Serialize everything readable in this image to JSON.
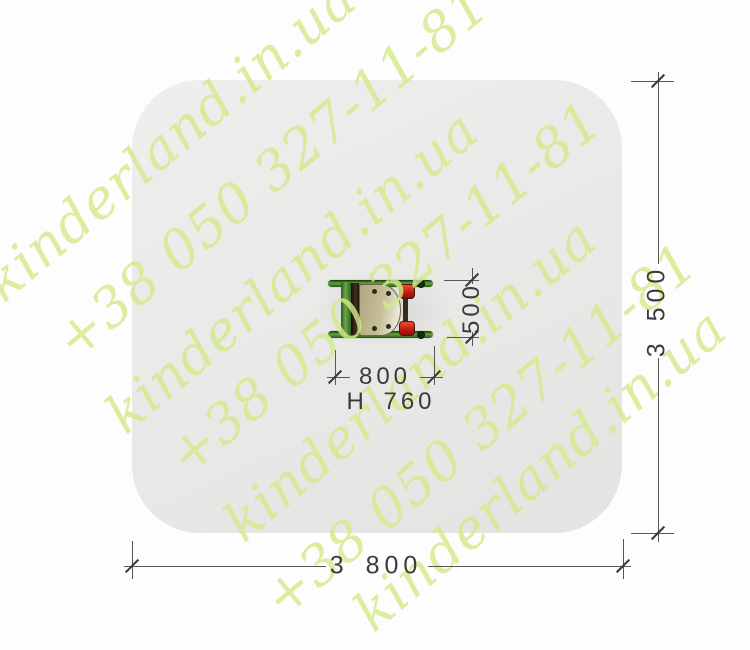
{
  "watermark": {
    "brand_text": "kinderland.in.ua",
    "phone_text": "+38 050 327-11-81",
    "color": "#d3e98a"
  },
  "dimensions": {
    "zone_width_label": "3 800",
    "zone_depth_label": "3 500",
    "equipment_width_label": "800",
    "equipment_depth_label": "500",
    "equipment_height_label": "H 760"
  },
  "equipment": {
    "view": "spring-rocker-top-view",
    "colors": {
      "frame_green": "#3f7d28",
      "handle_red": "#c5251a",
      "seat_beige": "#c0b990",
      "hardware_dark": "#2b2117"
    }
  },
  "zone": {
    "fill": "#e9e9e8"
  },
  "page": {
    "background": "#ffffff"
  }
}
